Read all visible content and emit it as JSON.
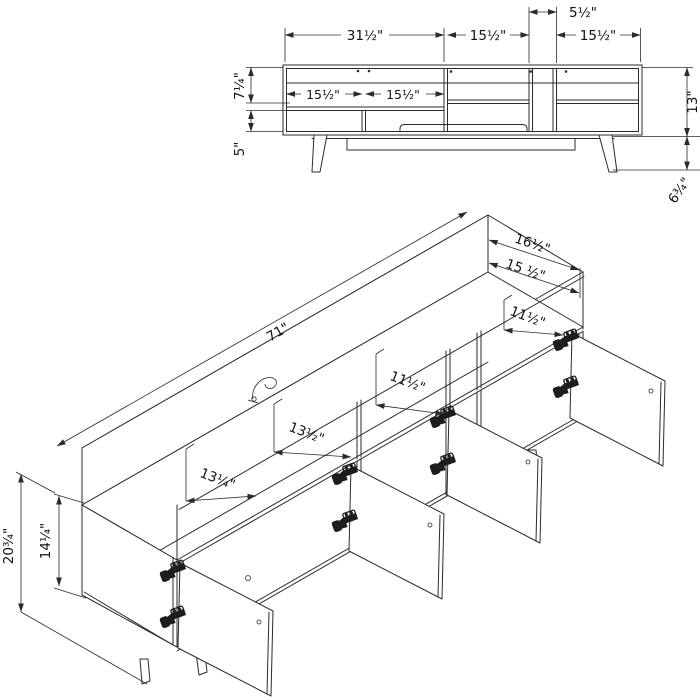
{
  "diagram": {
    "subject": "tv-stand-dimension-drawing",
    "colors": {
      "line": "#2b2b2b",
      "text": "#111111",
      "background": "#ffffff"
    },
    "front_view": {
      "dims": {
        "center_gap": "5½\"",
        "span_left": "31½\"",
        "span_mid": "15½\"",
        "span_right": "15½\"",
        "inner_left": "15½\"",
        "inner_right": "15½\"",
        "upper_height": "7¼\"",
        "lower_height": "5\"",
        "total_height": "13\"",
        "leg_height": "6¾\""
      }
    },
    "iso_view": {
      "dims": {
        "length": "71\"",
        "depth_outer": "16½\"",
        "depth_inner": "15 ½\"",
        "section_right": "11½\"",
        "section_mid_right": "11½\"",
        "section_mid_left": "13½\"",
        "section_left": "13¼\"",
        "side_height": "14¼\"",
        "total_height": "20¾\""
      }
    }
  }
}
